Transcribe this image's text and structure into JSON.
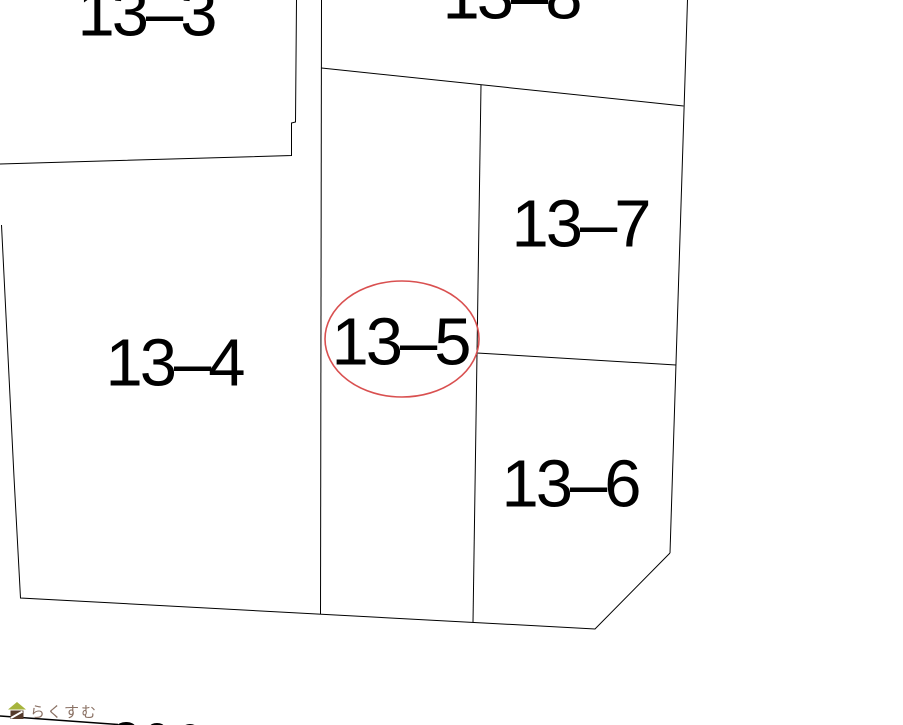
{
  "map": {
    "background_color": "#ffffff",
    "line_color": "#000000",
    "parcels": [
      {
        "id": "13-3",
        "label": "13-3",
        "note": "top-left, label clipped at top edge"
      },
      {
        "id": "13-8",
        "label": "13-8",
        "note": "top-center, label clipped at top edge"
      },
      {
        "id": "13-7",
        "label": "13-7",
        "note": "right-center parcel"
      },
      {
        "id": "13-5",
        "label": "13-5",
        "note": "center corridor parcel, circled in red"
      },
      {
        "id": "13-4",
        "label": "13-4",
        "note": "large left parcel"
      },
      {
        "id": "13-6",
        "label": "13-6",
        "note": "lower-right parcel with beveled corner"
      }
    ],
    "highlight": {
      "parcel": "13-5",
      "shape": "ellipse",
      "color": "#d95050"
    }
  },
  "watermark": {
    "logo_text": "らくすむ",
    "text_color": "#8a7164",
    "roof_color": "#a6b43c",
    "house_body_color": "#543a2b"
  }
}
